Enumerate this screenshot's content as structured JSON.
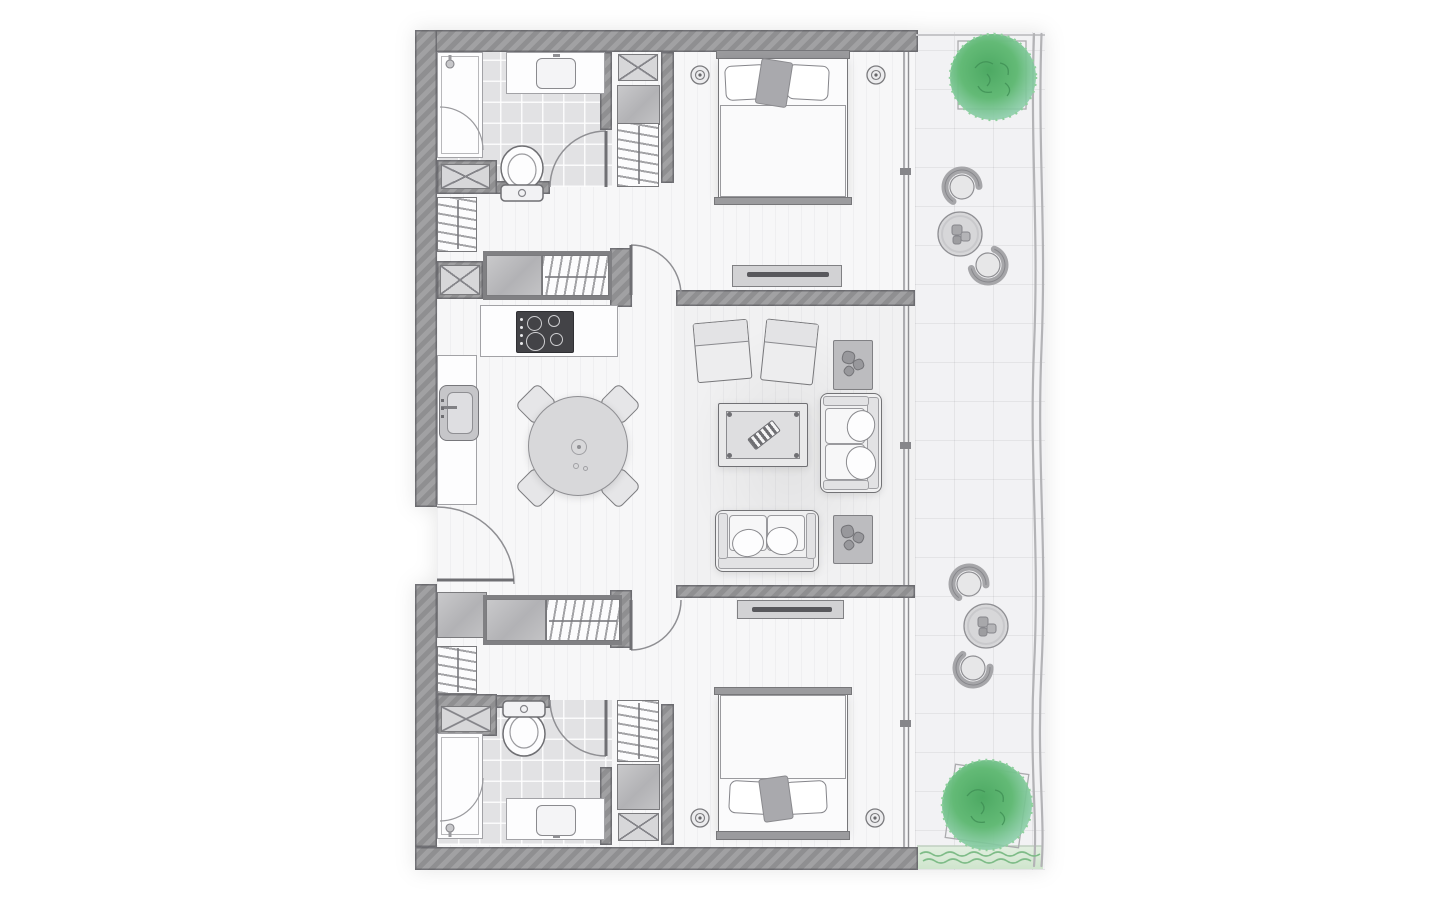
{
  "document": {
    "type": "architectural-floor-plan",
    "style": "hand-drawn-sketch",
    "subject": "two-bedroom-apartment-with-balcony",
    "text_labels_visible": "none"
  },
  "palette": {
    "background": "#ffffff",
    "wall": "#98989a",
    "wall_edge": "#5f5f66",
    "interior_floor": "#f7f7f8",
    "bathroom_tile": "#e2e2e4",
    "balcony_floor": "#f2f2f4",
    "greenery": "#5cb477",
    "greenery_dark": "#3f8f55",
    "grass": "#cfe5cd",
    "furniture_line": "#77777a",
    "glass_line": "#8f8f93",
    "railing": "#b3b3b6"
  },
  "rooms": [
    {
      "id": "bathroom-1",
      "position": "top-left",
      "fixtures": [
        "walk-in-shower",
        "vanity-sink",
        "toilet",
        "service-shaft"
      ]
    },
    {
      "id": "bedroom-1",
      "position": "top-right",
      "furniture": [
        "double-bed",
        "pillows",
        "throw-blanket",
        "nightstand-left",
        "table-lamp-left",
        "nightstand-right",
        "table-lamp-right",
        "tv-console",
        "built-in-closet",
        "shaft-box"
      ]
    },
    {
      "id": "hallway-upper",
      "position": "left-middle",
      "fixtures": [
        "wardrobe",
        "sliding-closet-with-hanging-rail",
        "service-shaft"
      ]
    },
    {
      "id": "kitchen-dining",
      "position": "center-left",
      "fixtures": [
        "cooktop-4-burners",
        "counter-top",
        "counter-left",
        "kitchen-sink",
        "round-dining-table",
        "dining-chair",
        "dining-chair",
        "dining-chair",
        "dining-chair",
        "entry-door"
      ]
    },
    {
      "id": "living-room",
      "position": "center-right",
      "furniture": [
        "armchair",
        "armchair",
        "coffee-table-with-striped-tray",
        "sofa-two-seat-vertical",
        "sofa-two-seat-horizontal",
        "plant-side-table",
        "plant-side-table"
      ]
    },
    {
      "id": "bathroom-2",
      "position": "bottom-left",
      "fixtures": [
        "walk-in-shower",
        "vanity-sink",
        "toilet",
        "service-shaft",
        "mirror-cabinet"
      ]
    },
    {
      "id": "bedroom-2",
      "position": "bottom-right",
      "furniture": [
        "double-bed",
        "pillows",
        "throw-blanket",
        "nightstand-left",
        "table-lamp-left",
        "nightstand-right",
        "table-lamp-right",
        "tv-console",
        "built-in-closet",
        "shaft-box"
      ]
    },
    {
      "id": "balcony",
      "position": "right-full-height",
      "fixtures": [
        "tree-in-planter-top",
        "tree-in-planter-bottom",
        "outdoor-chair",
        "outdoor-chair",
        "outdoor-chair",
        "outdoor-chair",
        "outdoor-round-table",
        "outdoor-round-table",
        "grass-border",
        "wavy-railing",
        "tile-grid"
      ]
    }
  ],
  "doors": [
    {
      "id": "entry-door",
      "location": "left-wall-middle"
    },
    {
      "id": "bathroom-1-door",
      "location": "bathroom-1-south"
    },
    {
      "id": "bedroom-1-door",
      "location": "hall-to-bedroom-1"
    },
    {
      "id": "bedroom-2-door",
      "location": "hall-to-bedroom-2"
    },
    {
      "id": "bathroom-2-door",
      "location": "bathroom-2-north"
    },
    {
      "id": "shower-1-door",
      "location": "bathroom-1"
    },
    {
      "id": "shower-2-door",
      "location": "bathroom-2"
    }
  ],
  "windows": [
    {
      "id": "glazed-wall-bedroom-1",
      "side": "east"
    },
    {
      "id": "glazed-wall-living-room",
      "side": "east"
    },
    {
      "id": "glazed-wall-bedroom-2",
      "side": "east"
    }
  ],
  "counts": {
    "bedrooms": 2,
    "bathrooms": 2,
    "balconies": 1,
    "trees": 2,
    "outdoor_seating_sets": 2,
    "sofas": 2,
    "armchairs": 2,
    "dining_chairs": 4
  }
}
